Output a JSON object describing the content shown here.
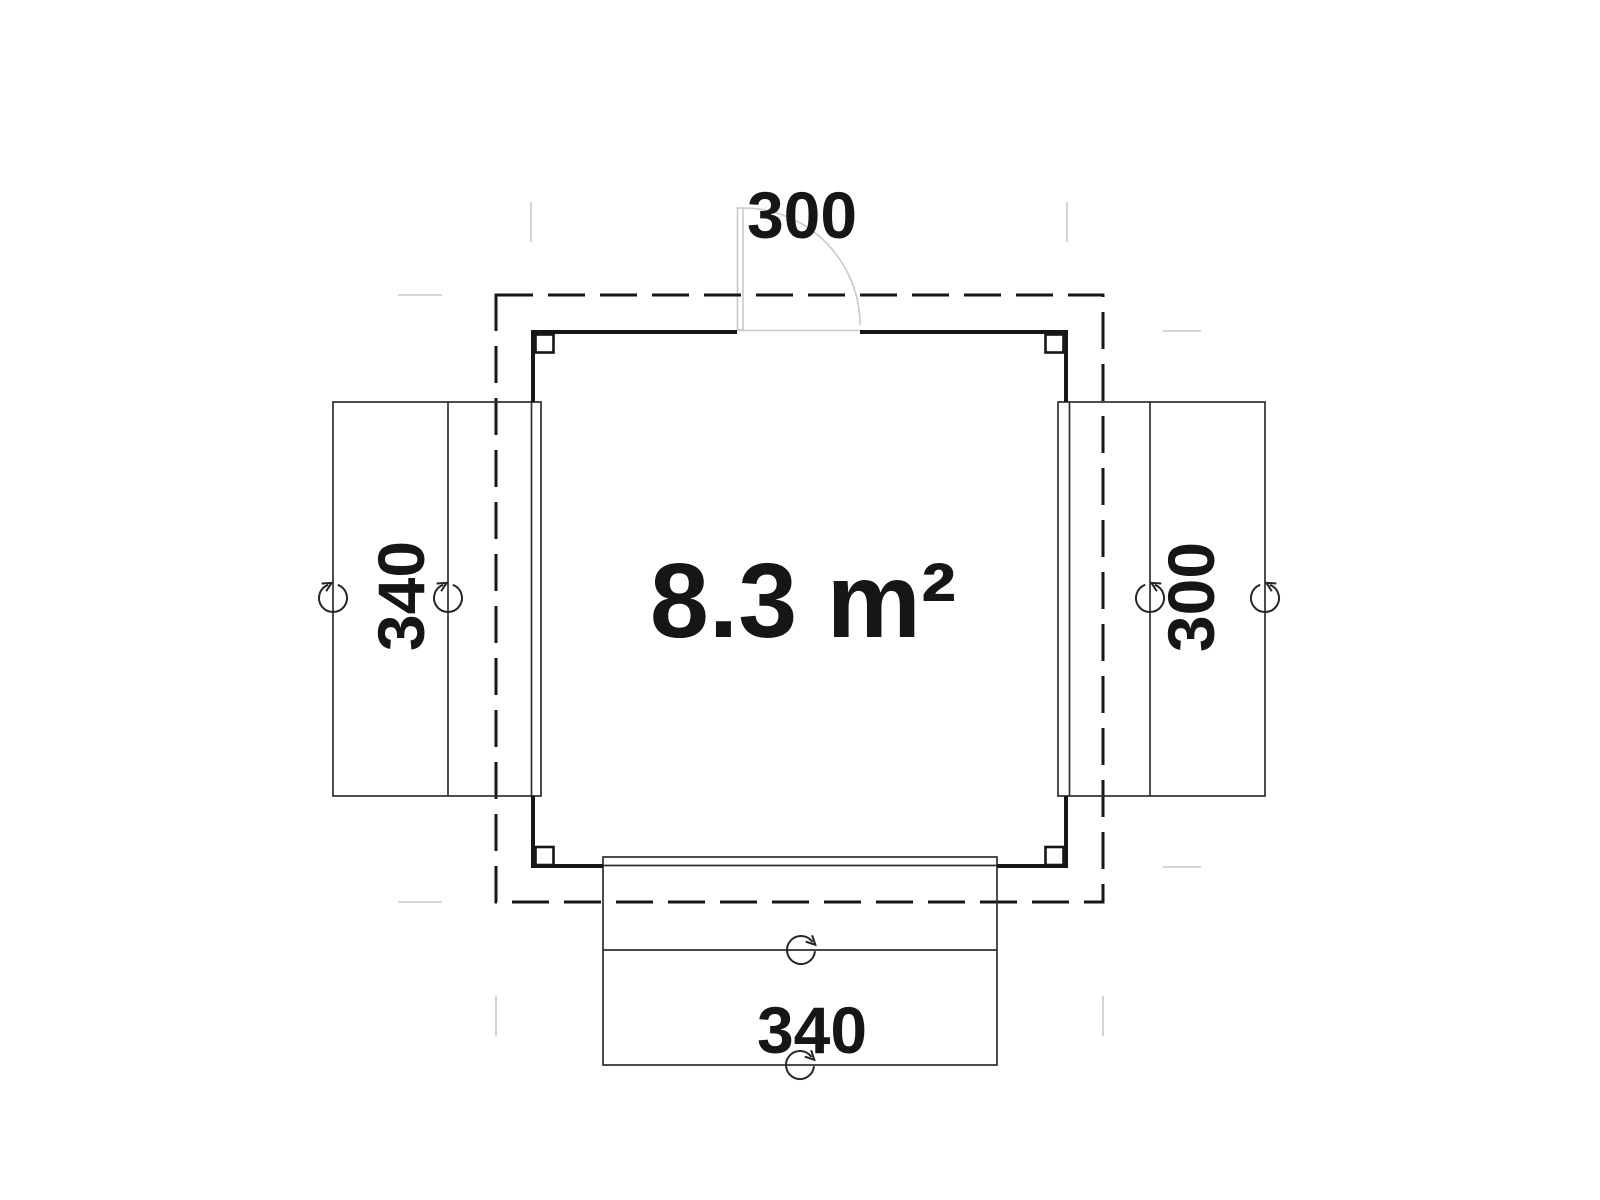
{
  "drawing": {
    "type": "floor-plan",
    "area_label": "8.3 m²",
    "dimensions": {
      "top": "300",
      "right": "300",
      "bottom": "340",
      "left": "340"
    }
  },
  "colors": {
    "ink": "#161616",
    "thin_line": "#2e2e2e",
    "light_line": "#c9c9c9",
    "symbol": "#262626",
    "background": "#ffffff"
  }
}
